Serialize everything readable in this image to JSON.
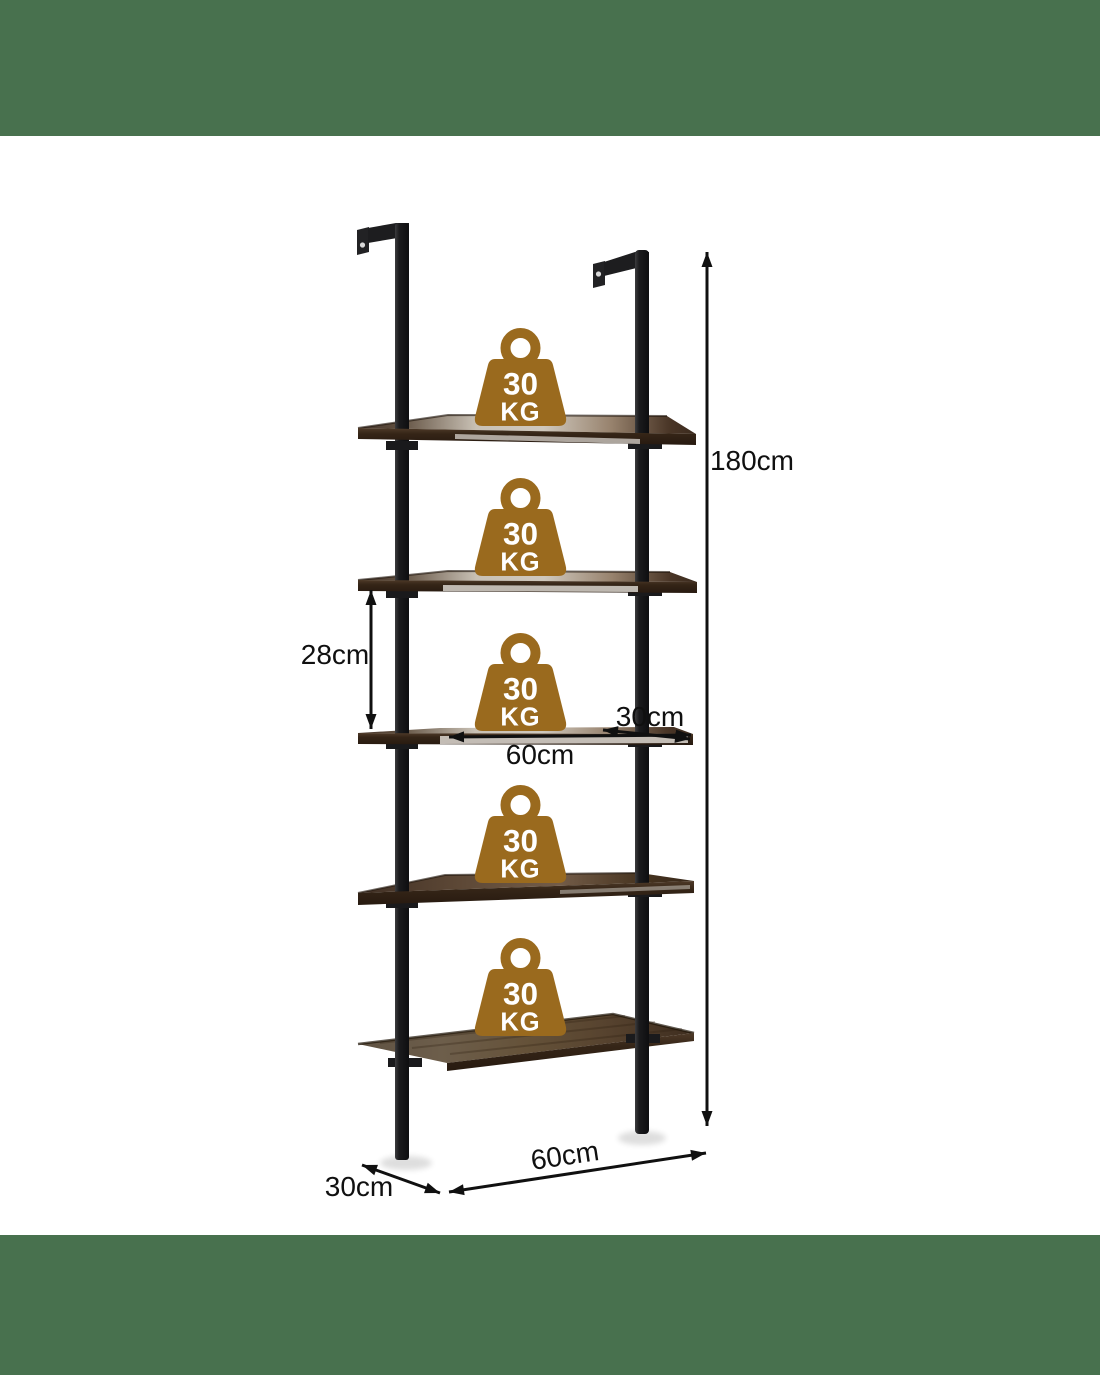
{
  "scene": {
    "type": "product-dimension-diagram",
    "background_color": "#ffffff",
    "top_band_color": "#48714e",
    "bottom_band_color": "#48714e"
  },
  "product": {
    "shelf_count": 5,
    "frame_color": "#1b1b1d",
    "shelf_front_color": "#33241a",
    "shelf_surface_light": "#cdc5ba",
    "shelf_surface_dark": "#43332a"
  },
  "weight_badge": {
    "value": "30",
    "unit": "KG",
    "color": "#9a6a1e",
    "count": 5
  },
  "dimensions": {
    "total_height": "180cm",
    "shelf_spacing": "28cm",
    "shelf_depth": "30cm",
    "shelf_width": "60cm",
    "base_width": "60cm",
    "base_depth": "30cm"
  }
}
